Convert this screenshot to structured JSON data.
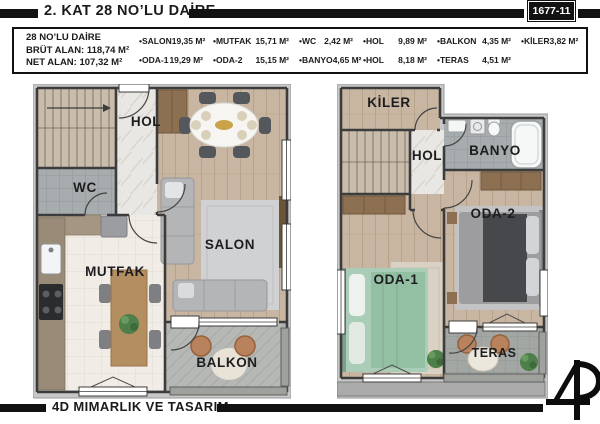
{
  "header": {
    "title": "2. KAT 28 NO’LU DAİRE",
    "sheet_number": "1677-11"
  },
  "info_box": {
    "unit_name": "28 NO’LU DAİRE",
    "gross_area": "BRÜT ALAN: 118,74 M²",
    "net_area": "NET ALAN: 107,32 M²",
    "rooms_row1": [
      {
        "name": "•SALON",
        "area": "19,35 M²"
      },
      {
        "name": "•MUTFAK",
        "area": "15,71 M²"
      },
      {
        "name": "•WC",
        "area": "2,42 M²"
      },
      {
        "name": "•HOL",
        "area": "9,89 M²"
      },
      {
        "name": "•BALKON",
        "area": "4,35 M²"
      },
      {
        "name": "•KİLER",
        "area": "3,82 M²"
      }
    ],
    "rooms_row2": [
      {
        "name": "•ODA-1",
        "area": "19,29 M²"
      },
      {
        "name": "•ODA-2",
        "area": "15,15 M²"
      },
      {
        "name": "•BANYO",
        "area": "4,65 M²"
      },
      {
        "name": "•HOL",
        "area": "8,18 M²"
      },
      {
        "name": "•TERAS",
        "area": "4,51 M²"
      }
    ]
  },
  "plans": {
    "left": {
      "labels": {
        "hol": "HOL",
        "wc": "WC",
        "salon": "SALON",
        "mutfak": "MUTFAK",
        "balkon": "BALKON"
      }
    },
    "right": {
      "labels": {
        "kiler": "KİLER",
        "hol": "HOL",
        "banyo": "BANYO",
        "oda2": "ODA-2",
        "oda1": "ODA-1",
        "teras": "TERAS"
      }
    }
  },
  "footer": {
    "company": "4D MIMARLIK VE TASARIM"
  },
  "colors": {
    "bar_black": "#121212",
    "wall": "#3c3c3c",
    "wood_floor": "#c8b6a2",
    "marble_floor": "#e9e7e3",
    "tile_gray": "#a7acae",
    "kitchen_floor": "#f1ede6",
    "balcony_gray": "#b6b8b5",
    "exterior_band": "#c8c8c8",
    "stair": "#cabdab",
    "wardrobe_brown": "#8d7052",
    "bed_green": "#a9cdb6",
    "bed_dark": "#47484c"
  }
}
